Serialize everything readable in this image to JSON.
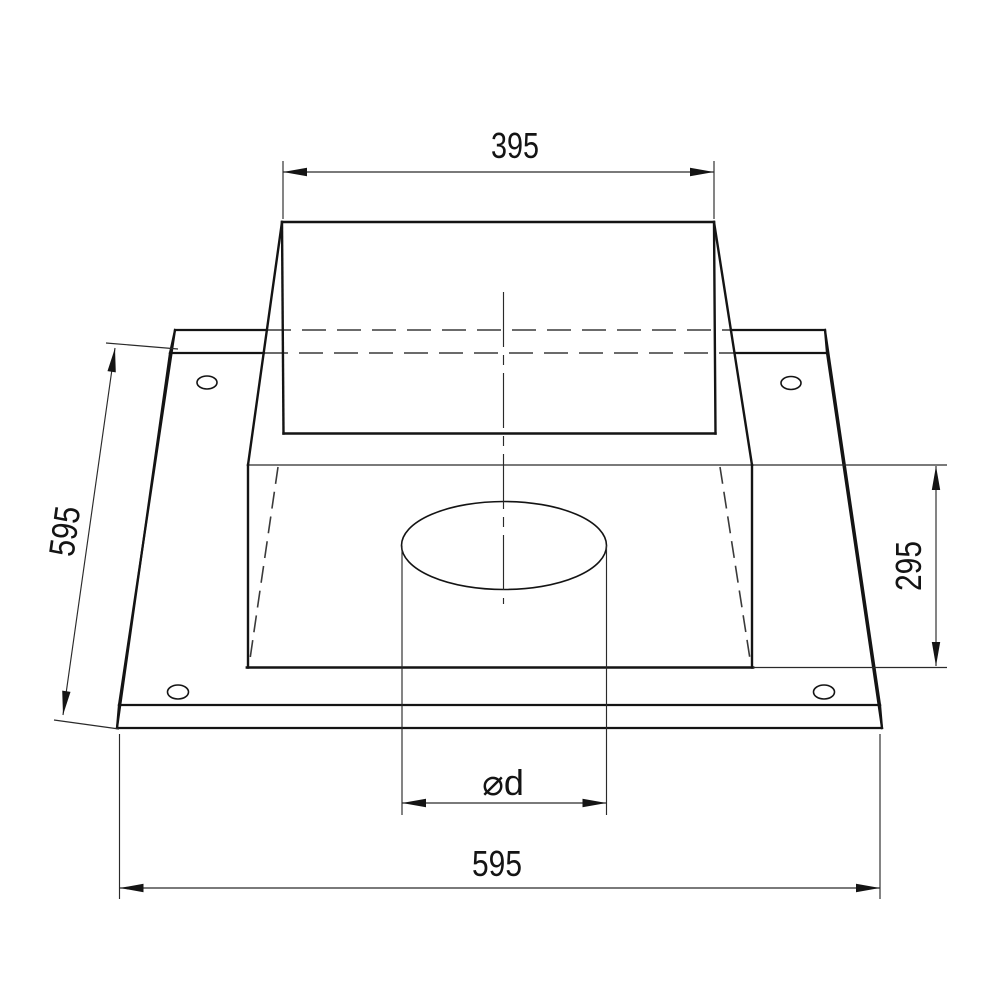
{
  "drawing": {
    "type": "technical-drawing",
    "subject": "square base plate with rectangular collar and round hole",
    "dimensions": {
      "collar_width": "395",
      "plate_depth": "595",
      "collar_depth": "295",
      "hole_diameter": "⌀d",
      "plate_width": "595"
    },
    "colors": {
      "line": "#141414",
      "background": "#ffffff"
    }
  }
}
